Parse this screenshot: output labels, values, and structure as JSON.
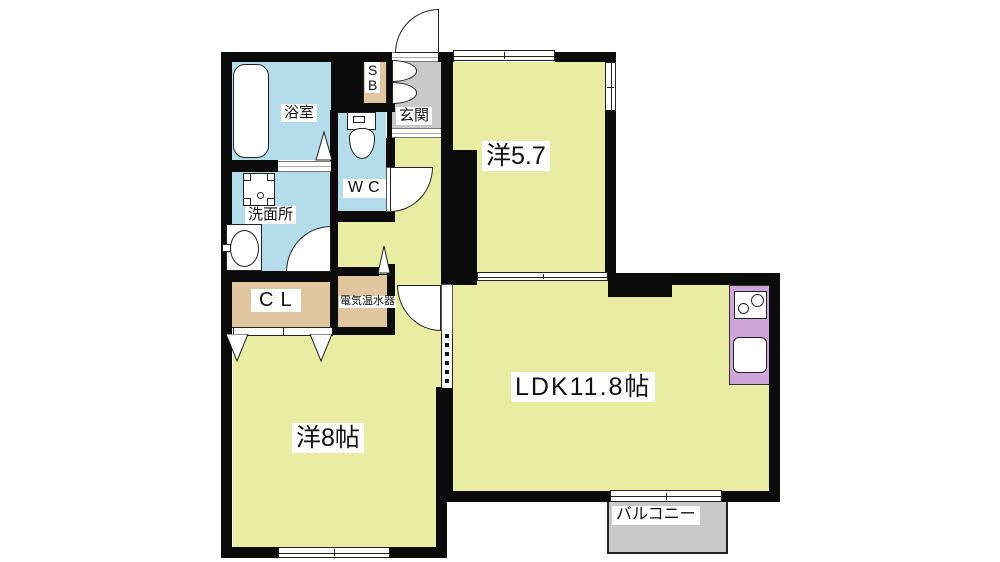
{
  "plan": {
    "type": "apartment-floor-plan",
    "rooms": {
      "bath": "浴室",
      "washroom": "洗面所",
      "wc": "WC",
      "sb_line1": "S",
      "sb_line2": "B",
      "entrance": "玄関",
      "western57": "洋5.7",
      "ldk": "LDK11.8帖",
      "western8": "洋8帖",
      "closet": "CL",
      "water_heater": "電気温水器",
      "balcony": "バルコニー"
    },
    "colors": {
      "room_yellow": "#e9eda4",
      "wet_area_blue": "#b5dcea",
      "storage_tan": "#e0c69e",
      "entrance_gray": "#c9c9c9",
      "kitchen_purple": "#cfa5da",
      "wall_black": "#0b0b0b"
    }
  }
}
